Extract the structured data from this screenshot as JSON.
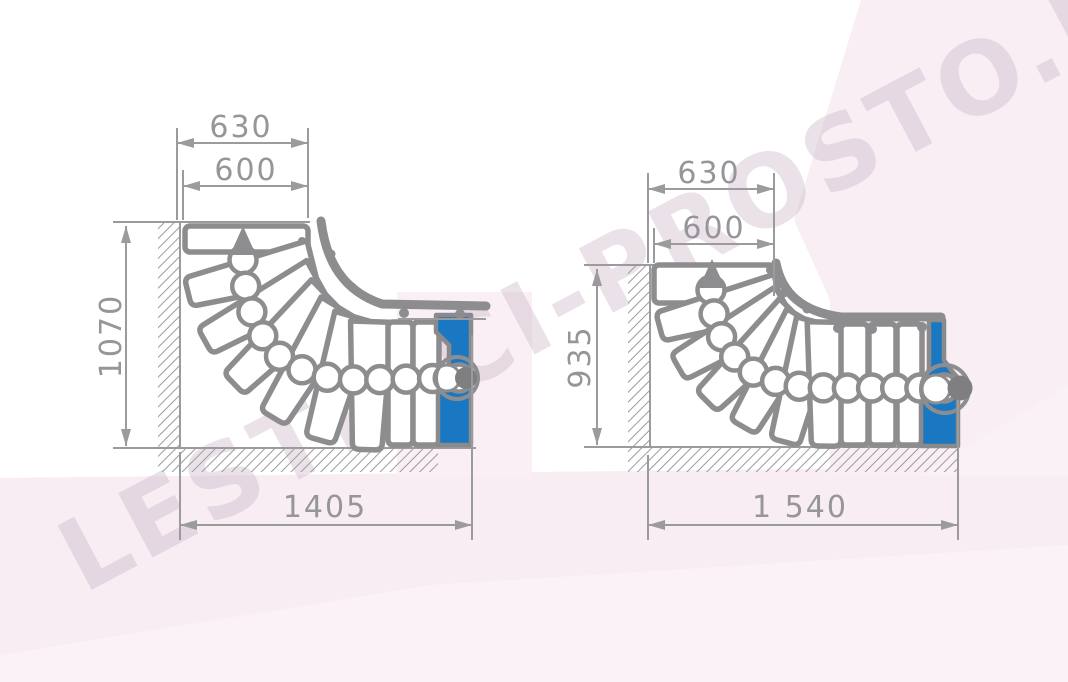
{
  "watermark": {
    "text": "LESTNICI-PROSTO.RU"
  },
  "left_diagram": {
    "top_width_outer": "630",
    "tread_width": "600",
    "height": "1070",
    "total_length": "1405"
  },
  "right_diagram": {
    "top_width_outer": "630",
    "tread_width": "600",
    "height": "935",
    "total_length": "1 540"
  },
  "colors": {
    "outline_gray": "#8d8d8f",
    "dimension_gray": "#9b9b9e",
    "accent_blue": "#1a78c2",
    "pole_gray": "#7f7f81",
    "background_pink": "#f7edf3",
    "watermark_pink": "#cdbbc9"
  },
  "icons": {
    "direction_up_arrow": "filled triangle pointing up along walk line"
  }
}
